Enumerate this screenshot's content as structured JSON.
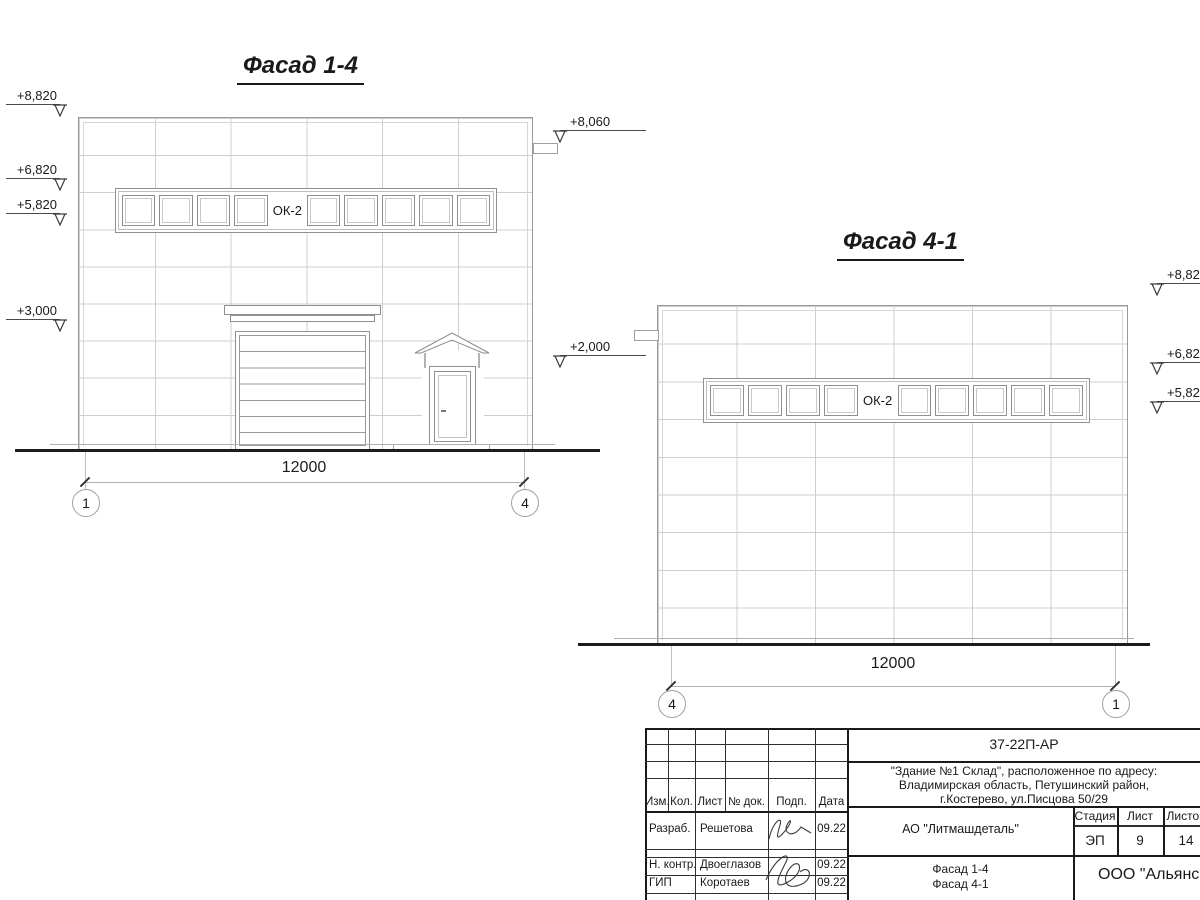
{
  "facade14": {
    "title": "Фасад 1-4",
    "window_label": "ОК-2",
    "dimension": "12000",
    "axis_left": "1",
    "axis_right": "4",
    "marks_left": [
      "+8,820",
      "+6,820",
      "+5,820",
      "+3,000"
    ],
    "marks_mid": [
      "+8,060",
      "+2,000"
    ]
  },
  "facade41": {
    "title": "Фасад 4-1",
    "window_label": "ОК-2",
    "dimension": "12000",
    "axis_left": "4",
    "axis_right": "1",
    "marks_right": [
      "+8,820",
      "+6,820",
      "+5,820"
    ]
  },
  "title_block": {
    "doc_code": "37-22П-АР",
    "object_address": [
      "\"Здание №1 Склад\", расположенное по адресу:",
      "Владимирская область, Петушинский район,",
      "г.Костерево, ул.Писцова 50/29"
    ],
    "client": "АО \"Литмашдеталь\"",
    "stage_label": "Стадия",
    "sheet_label": "Лист",
    "sheets_label": "Листов",
    "stage_value": "ЭП",
    "sheet_value": "9",
    "sheets_value": "14",
    "sheet_title": [
      "Фасад 1-4",
      "Фасад 4-1"
    ],
    "organization": "ООО \"Альянс\"",
    "header_columns": [
      "Изм.",
      "Кол.",
      "Лист",
      "№ док.",
      "Подп.",
      "Дата"
    ],
    "signature_rows": [
      {
        "role": "Разраб.",
        "name": "Решетова",
        "date": "09.22"
      },
      {
        "role": "Н. контр.",
        "name": "Двоеглазов",
        "date": "09.22"
      },
      {
        "role": "ГИП",
        "name": "Коротаев",
        "date": "09.22"
      }
    ]
  }
}
